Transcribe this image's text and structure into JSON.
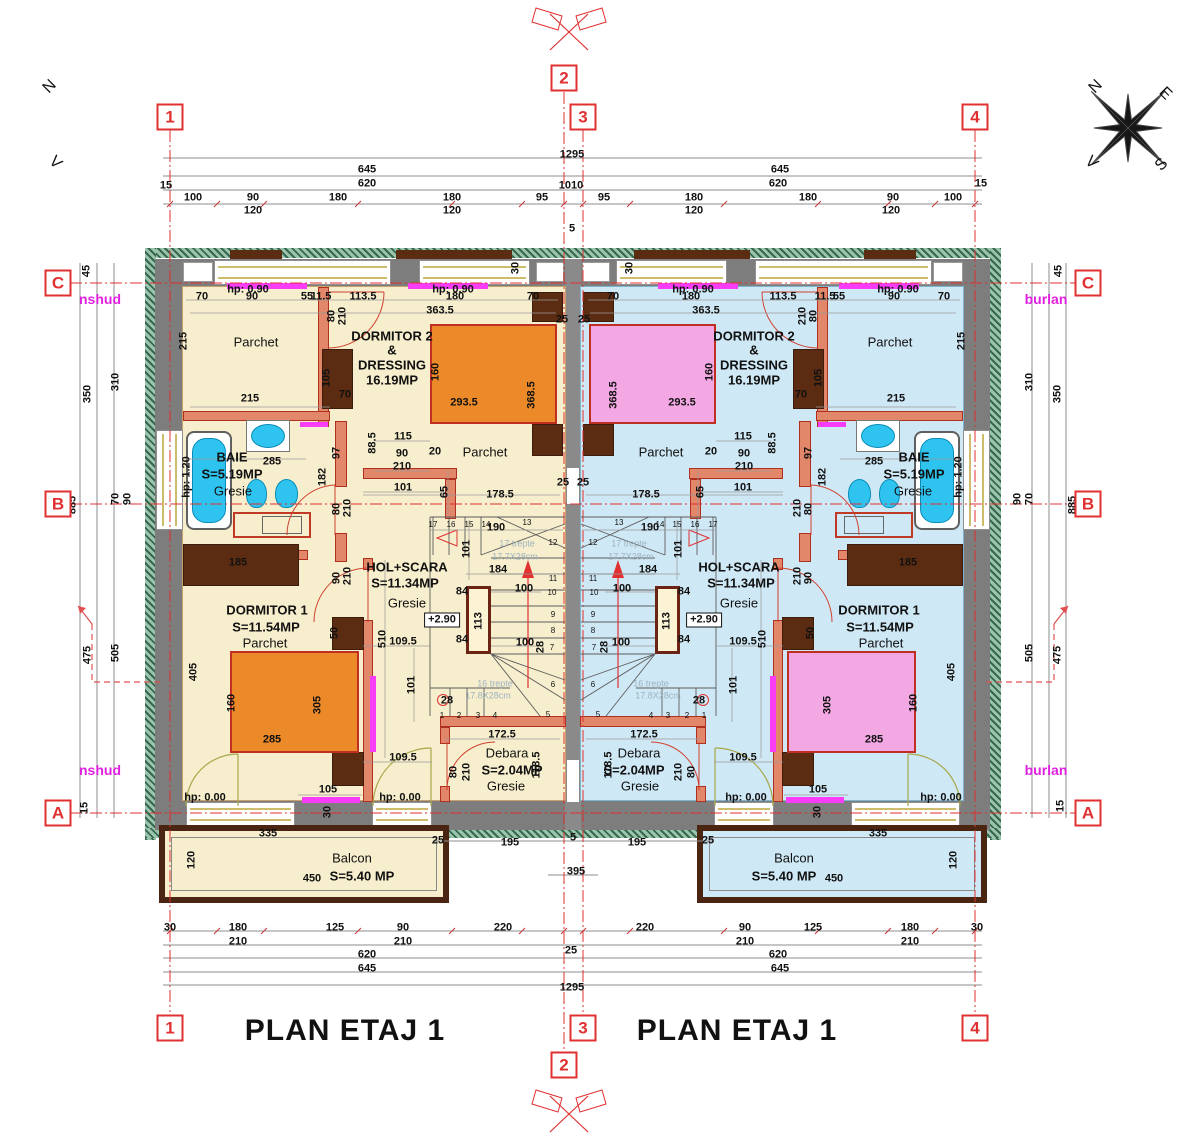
{
  "drawing": {
    "title_left": "PLAN ETAJ 1",
    "title_right": "PLAN ETAJ 1"
  },
  "compass": {
    "n": "N",
    "e": "E",
    "s": "S",
    "w": "V"
  },
  "grid": {
    "cols": [
      "1",
      "2",
      "3",
      "4"
    ],
    "rows": [
      "C",
      "B",
      "A"
    ]
  },
  "side_notes": {
    "left_top": "nshud",
    "left_bottom": "nshud",
    "right_top": "burlan",
    "right_bottom": "burlan"
  },
  "colors": {
    "floor_left": "#f6eecd",
    "floor_right": "#cfe8f5",
    "bed_left": "#ec8a2a",
    "bed_right": "#f3a8e4",
    "axis_red": "#e03030",
    "note_magenta": "#e020e0"
  },
  "dims": {
    "top": [
      "1295",
      "645",
      "645",
      "15",
      "620",
      "1010",
      "620",
      "15",
      "100",
      "90",
      "180",
      "180",
      "95",
      "95",
      "180",
      "180",
      "90",
      "100",
      "120",
      "120",
      "120",
      "120",
      "5"
    ],
    "bottom": [
      "30",
      "180",
      "125",
      "90",
      "220",
      "220",
      "90",
      "125",
      "180",
      "30",
      "210",
      "210",
      "210",
      "210",
      "620",
      "25",
      "620",
      "645",
      "645",
      "1295",
      "395",
      "5",
      "195",
      "195"
    ],
    "left": [
      "45",
      "310",
      "350",
      "70",
      "90",
      "885",
      "475",
      "505",
      "15"
    ],
    "right": [
      "45",
      "310",
      "350",
      "70",
      "90",
      "885",
      "505",
      "475",
      "15"
    ]
  },
  "unit": {
    "dims": [
      "70",
      "90",
      "55",
      "11.5",
      "113.5",
      "180",
      "70",
      "363.5",
      "215",
      "215",
      "80",
      "210",
      "30",
      "25",
      "105",
      "70",
      "160",
      "293.5",
      "368.5",
      "115",
      "88.5",
      "90",
      "20",
      "210",
      "285",
      "97",
      "182",
      "80",
      "210",
      "101",
      "65",
      "178.5",
      "25",
      "190",
      "101",
      "184",
      "100",
      "84",
      "113",
      "84",
      "100",
      "28",
      "28",
      "109.5",
      "510",
      "101",
      "109.5",
      "185",
      "90",
      "210",
      "405",
      "160",
      "305",
      "285",
      "50",
      "105",
      "30",
      "172.5",
      "80",
      "210",
      "118.5"
    ],
    "rooms": [
      "Parchet",
      "DORMITOR 2",
      "&",
      "DRESSING",
      "16.19MP",
      "Parchet",
      "BAIE",
      "S=5.19MP",
      "Gresie",
      "HOL+SCARA",
      "S=11.34MP",
      "Gresie",
      "DORMITOR 1",
      "S=11.54MP",
      "Parchet",
      "Debara",
      "S=2.04MP",
      "Gresie",
      "Balcon",
      "S=5.40 MP",
      "450",
      "335",
      "120",
      "25"
    ],
    "hp": [
      "hp: 0.90",
      "hp: 0.90",
      "hp: 1.20",
      "hp: 0.00",
      "hp: 0.00",
      "+2.90"
    ],
    "treads": [
      "1",
      "2",
      "3",
      "4",
      "5",
      "6",
      "7",
      "8",
      "9",
      "10",
      "11",
      "12",
      "13",
      "14",
      "15",
      "16",
      "17"
    ],
    "stair_notes": [
      "17 trepte",
      "17.7X28cm",
      "16 trepte",
      "17.8X28cm"
    ]
  }
}
